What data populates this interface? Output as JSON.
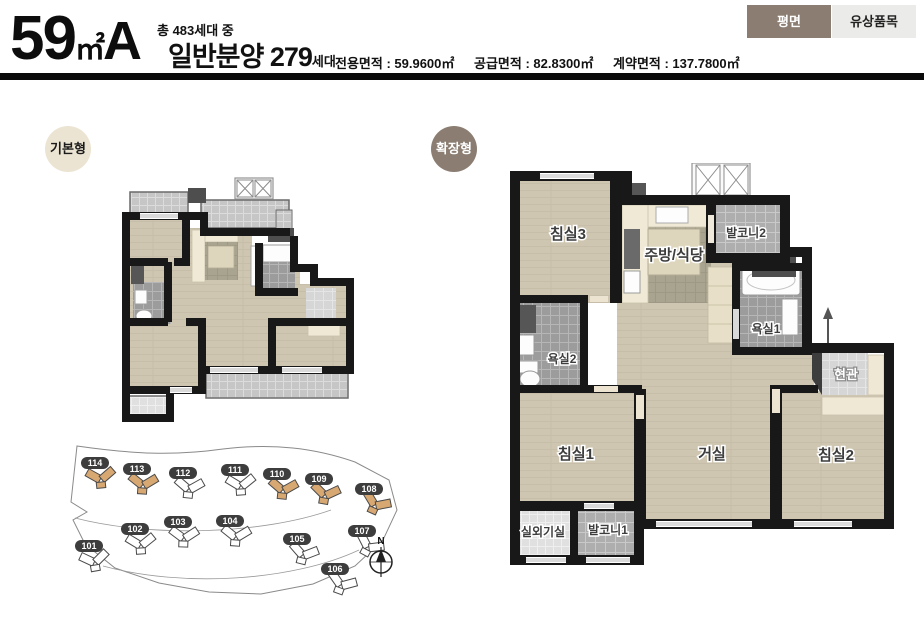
{
  "header": {
    "size_number": "59",
    "size_unit": "㎡",
    "size_variant": "A",
    "total_units": "총 483세대 중",
    "general_sale": "일반분양 279",
    "general_sale_suffix": "세대",
    "areas": [
      "전용면적 : 59.9600㎡",
      "공급면적 : 82.8300㎡",
      "계약면적 : 137.7800㎡"
    ],
    "tabs": [
      {
        "label": "평면",
        "active": true
      },
      {
        "label": "유상품목",
        "active": false
      }
    ]
  },
  "sections": {
    "basic_label": "기본형",
    "extended_label": "확장형"
  },
  "extended_plan": {
    "rooms": {
      "bedroom3": "침실3",
      "kitchen": "주방/식당",
      "balcony2": "발코니2",
      "bath1": "욕실1",
      "bath2": "욕실2",
      "entrance": "현관",
      "bedroom1": "침실1",
      "living": "거실",
      "bedroom2": "침실2",
      "outdoor_unit": "실외기실",
      "balcony1": "발코니1"
    }
  },
  "site_map": {
    "compass": "N",
    "buildings": [
      {
        "no": "114",
        "highlight": true
      },
      {
        "no": "113",
        "highlight": true
      },
      {
        "no": "112",
        "highlight": false
      },
      {
        "no": "111",
        "highlight": false
      },
      {
        "no": "110",
        "highlight": true
      },
      {
        "no": "109",
        "highlight": true
      },
      {
        "no": "108",
        "highlight": true
      },
      {
        "no": "101",
        "highlight": false
      },
      {
        "no": "102",
        "highlight": false
      },
      {
        "no": "103",
        "highlight": false
      },
      {
        "no": "104",
        "highlight": false
      },
      {
        "no": "105",
        "highlight": false
      },
      {
        "no": "106",
        "highlight": false
      },
      {
        "no": "107",
        "highlight": false
      }
    ]
  },
  "colors": {
    "tab_active_bg": "#8b7d71",
    "tab_inactive_bg": "#ebebe9",
    "basic_badge_bg": "#ece4d2",
    "extended_badge_bg": "#8b7d71",
    "building_highlight": "#d8a872",
    "wall": "#181818"
  }
}
